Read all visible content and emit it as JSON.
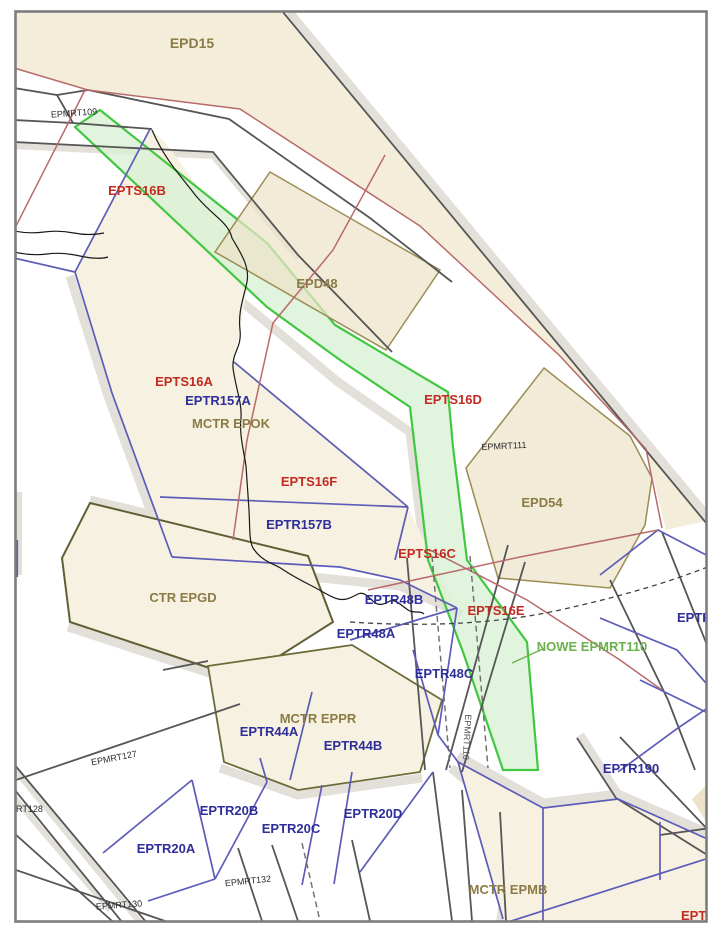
{
  "map": {
    "description": "Aeronautical airspace chart, Gdansk bay area (Poland): danger (EPD), restricted (EPTS), TRA (EPTR), CTR/MCTR zones and MRT routes with new green corridor NOWE EPMRT110",
    "labels": {
      "epd15": "EPD15",
      "epmrt109": "EPMRT109",
      "epts16b": "EPTS16B",
      "epd48": "EPD48",
      "epts16a": "EPTS16A",
      "eptr157a": "EPTR157A",
      "mctr_epok": "MCTR EPOK",
      "epts16f": "EPTS16F",
      "eptr157b": "EPTR157B",
      "ctr_epgd": "CTR EPGD",
      "epts16d": "EPTS16D",
      "epmrt111": "EPMRT111",
      "epd54": "EPD54",
      "epts16c": "EPTS16C",
      "eptr48b": "EPTR48B",
      "epts16e": "EPTS16E",
      "nowe_epmrt110": "NOWE EPMRT110",
      "eptr48a": "EPTR48A",
      "eptr48c": "EPTR48C",
      "eptr_right": "EPTR",
      "epmrt127": "EPMRT127",
      "mctr_eppr": "MCTR EPPR",
      "eptr44a": "EPTR44A",
      "eptr44b": "EPTR44B",
      "eptr20b": "EPTR20B",
      "eptr20c": "EPTR20C",
      "eptr20d": "EPTR20D",
      "eptr20a": "EPTR20A",
      "rt128": "RT128",
      "epmrt130": "EPMRT130",
      "epmrt132": "EPMRT132",
      "epmrt110_vert": "EPMRT110",
      "eptr190": "EPTR190",
      "mctr_epmb": "MCTR EPMB",
      "epts_clip": "EPTS"
    },
    "colors": {
      "danger_zone_fill": "#ece3c8",
      "zone_fill": "#f7f1e1",
      "epd15_fill": "#f3edda",
      "corridor_fill": "#d9f1d4",
      "corridor_stroke": "#42c742",
      "restricted_label": "#c32a22",
      "tra_label": "#2e2e9a",
      "danger_label": "#8b7b45",
      "new_route_label": "#6cb24c",
      "route_line_blue": "#5c5cb8",
      "boundary_line_gray": "#565656",
      "red_line": "#b96a6a",
      "shadow_band": "#e3e0d9"
    }
  }
}
